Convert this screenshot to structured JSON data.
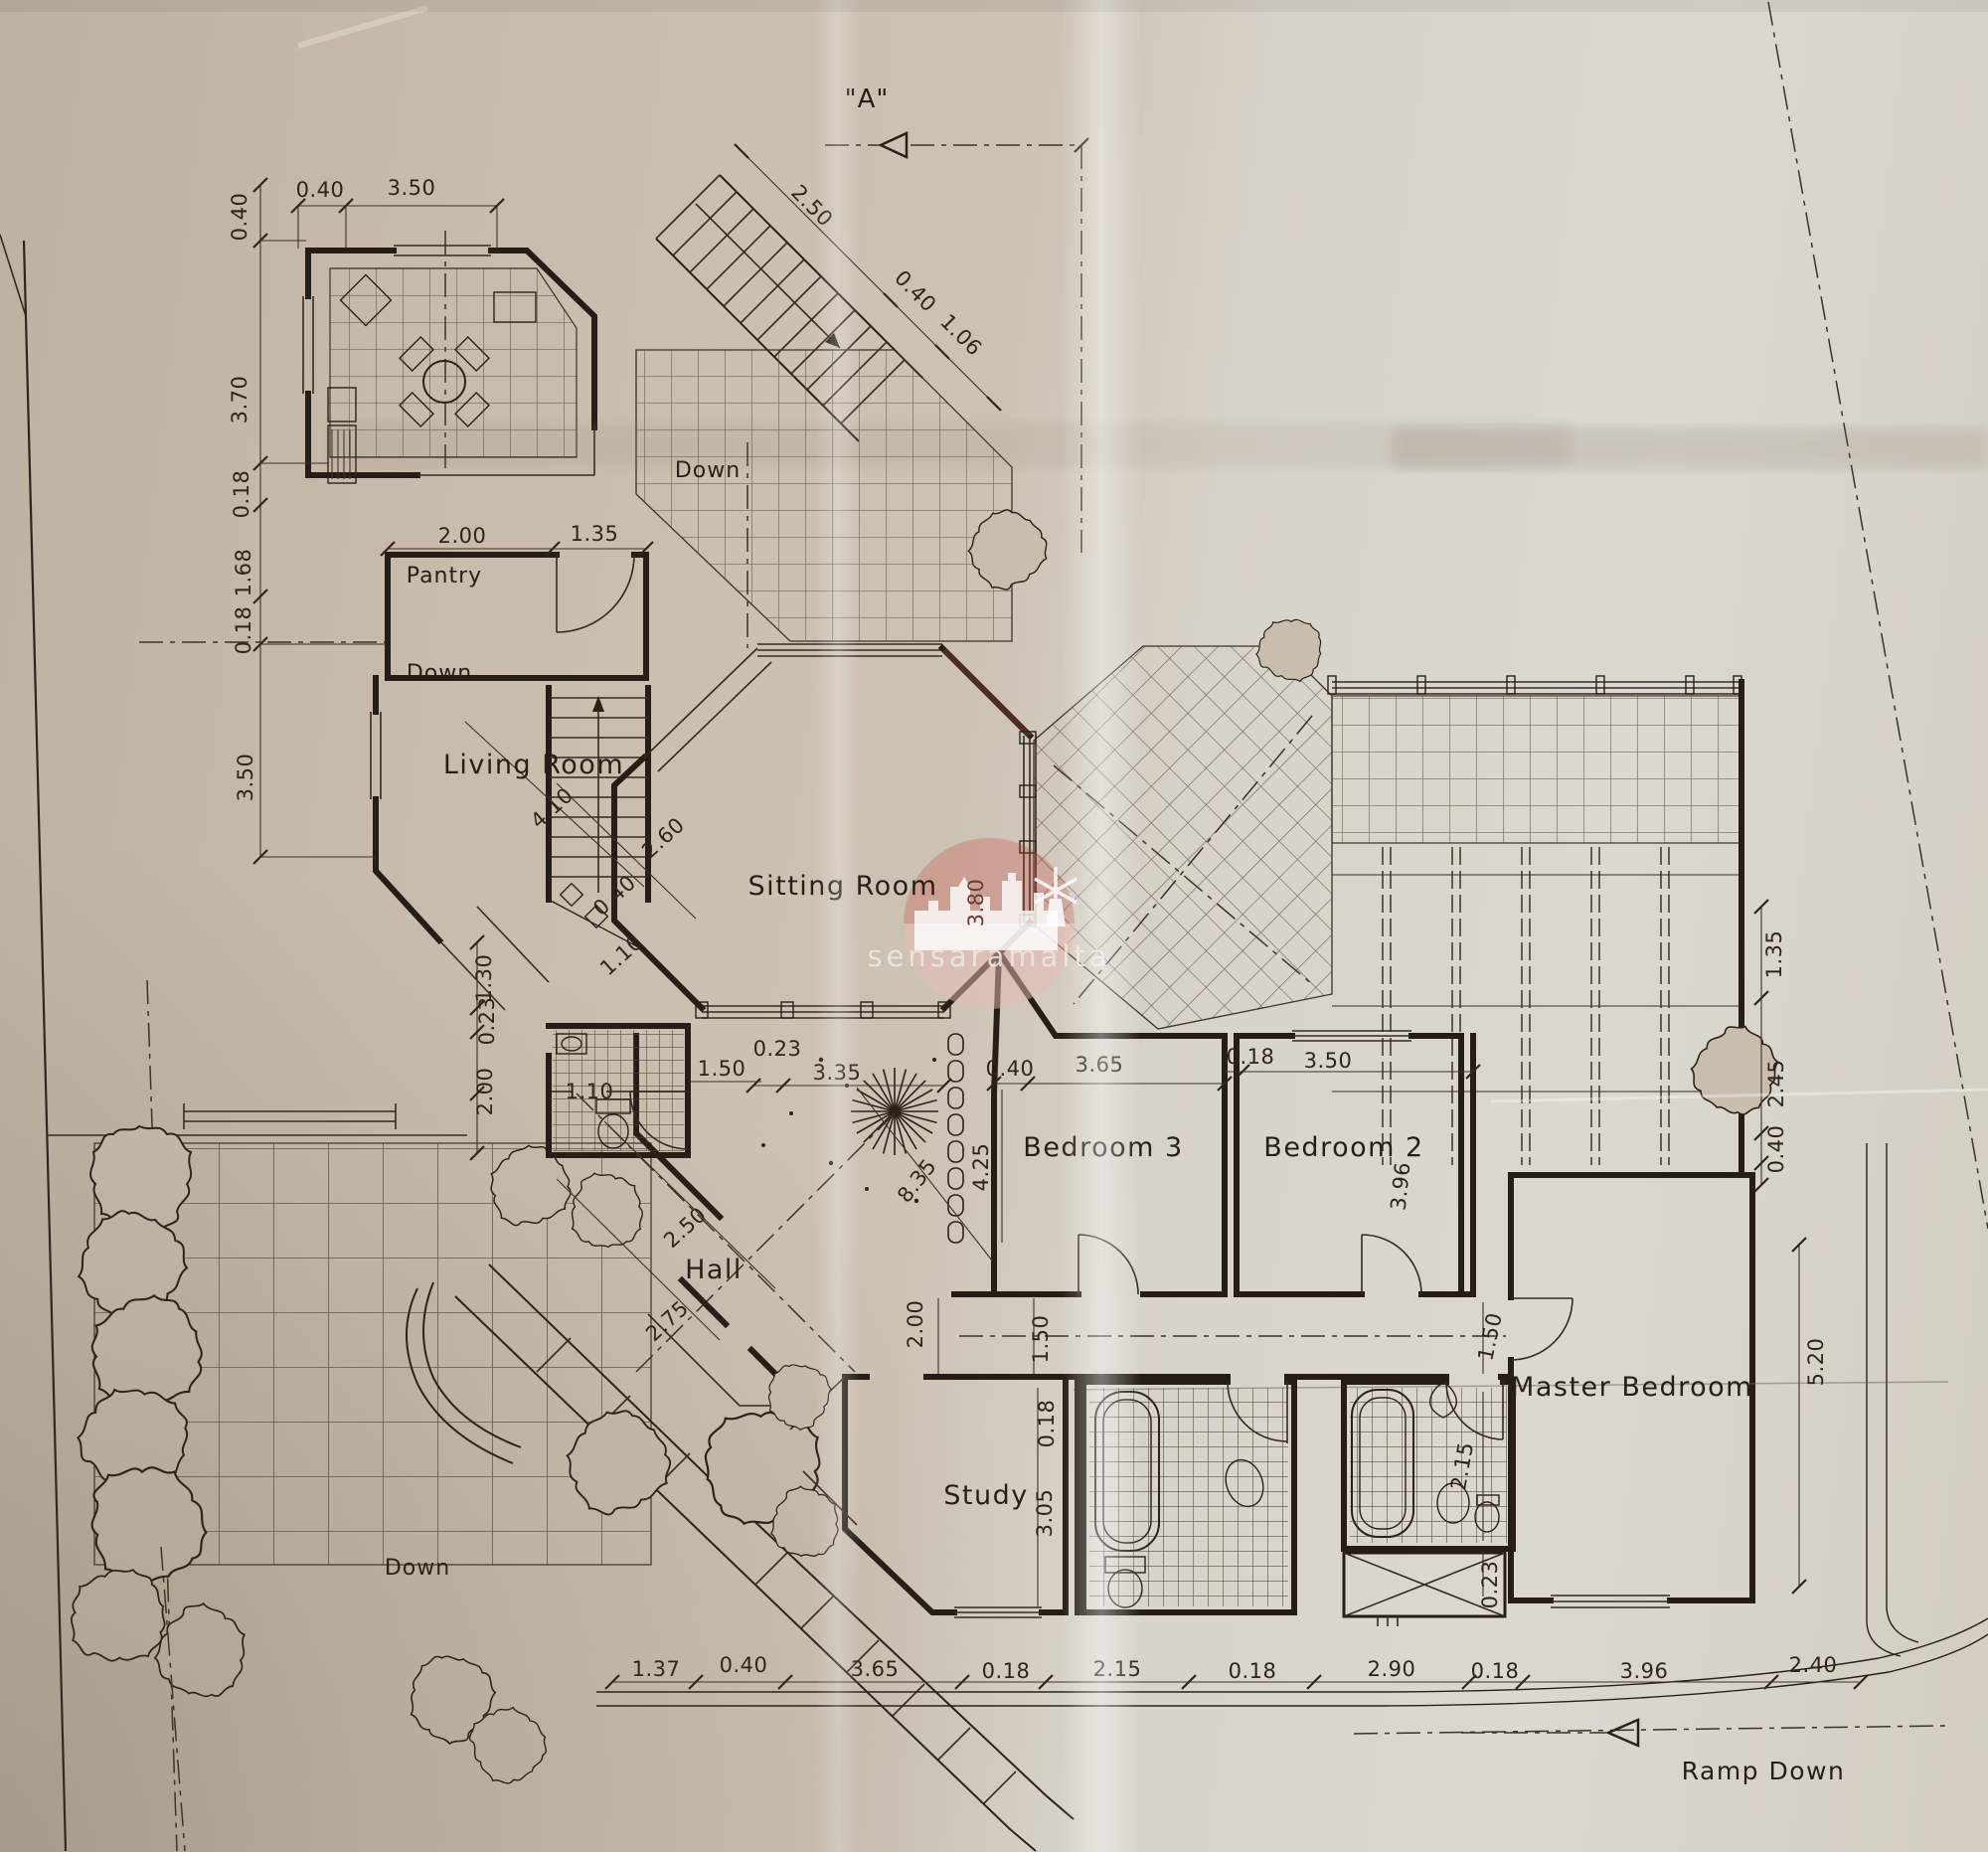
{
  "paper": {
    "base": "#cdc3b5",
    "ink": "#2a211a",
    "accent_red": "#c4392f"
  },
  "watermark": {
    "text": "sensaramalta"
  },
  "marker": {
    "section_a": "\"A\""
  },
  "rooms": {
    "pantry": "Pantry",
    "living_room": "Living Room",
    "sitting_room": "Sitting Room",
    "hall": "Hall",
    "bedroom3": "Bedroom 3",
    "bedroom2": "Bedroom 2",
    "master_bedroom": "Master Bedroom",
    "study": "Study"
  },
  "annotations": {
    "down_top": "Down",
    "down_inner": "Down",
    "down_terrace": "Down",
    "ramp_down": "Ramp Down"
  },
  "dims": {
    "left_0_40": "0.40",
    "left_3_70": "3.70",
    "left_0_18_a": "0.18",
    "left_1_68": "1.68",
    "left_0_18_b": "0.18",
    "left_3_50": "3.50",
    "top_0_40": "0.40",
    "top_3_50": "3.50",
    "stair_2_50": "2.50",
    "stair_0_40": "0.40",
    "stair_1_06": "1.06",
    "pantry_2_00": "2.00",
    "pantry_1_35": "1.35",
    "living_4_10": "4.10",
    "living_2_60": "2.60",
    "living_0_40": "0.40",
    "living_1_10": "1.10",
    "sitting_3_80": "3.80",
    "wc_1_30": "1.30",
    "wc_0_23": "0.23",
    "wc_2_00": "2.00",
    "wc_1_10": "1.10",
    "wc_1_50": "1.50",
    "court_0_23": "0.23",
    "court_3_35": "3.35",
    "court_8_35": "8.35",
    "court_2_00": "2.00",
    "court_4_25": "4.25",
    "b3_0_40": "0.40",
    "b3_3_65": "3.65",
    "b2_0_18": "0.18",
    "b2_3_50": "3.50",
    "b2_3_96": "3.96",
    "cor_1_50": "1.50",
    "cor_0_18": "0.18",
    "study_3_05": "3.05",
    "hall_2_50": "2.50",
    "hall_2_75": "2.75",
    "mb_1_50": "1.50",
    "mb_2_15": "2.15",
    "mb_0_23": "0.23",
    "mb_5_20": "5.20",
    "right_1_35": "1.35",
    "right_2_45": "2.45",
    "right_0_40": "0.40",
    "bottom_1_37": "1.37",
    "bottom_0_40": "0.40",
    "bottom_3_65": "3.65",
    "bottom_0_18_a": "0.18",
    "bottom_2_15": "2.15",
    "bottom_0_18_b": "0.18",
    "bottom_2_90": "2.90",
    "bottom_0_18_c": "0.18",
    "bottom_3_96": "3.96",
    "bottom_2_40": "2.40"
  }
}
